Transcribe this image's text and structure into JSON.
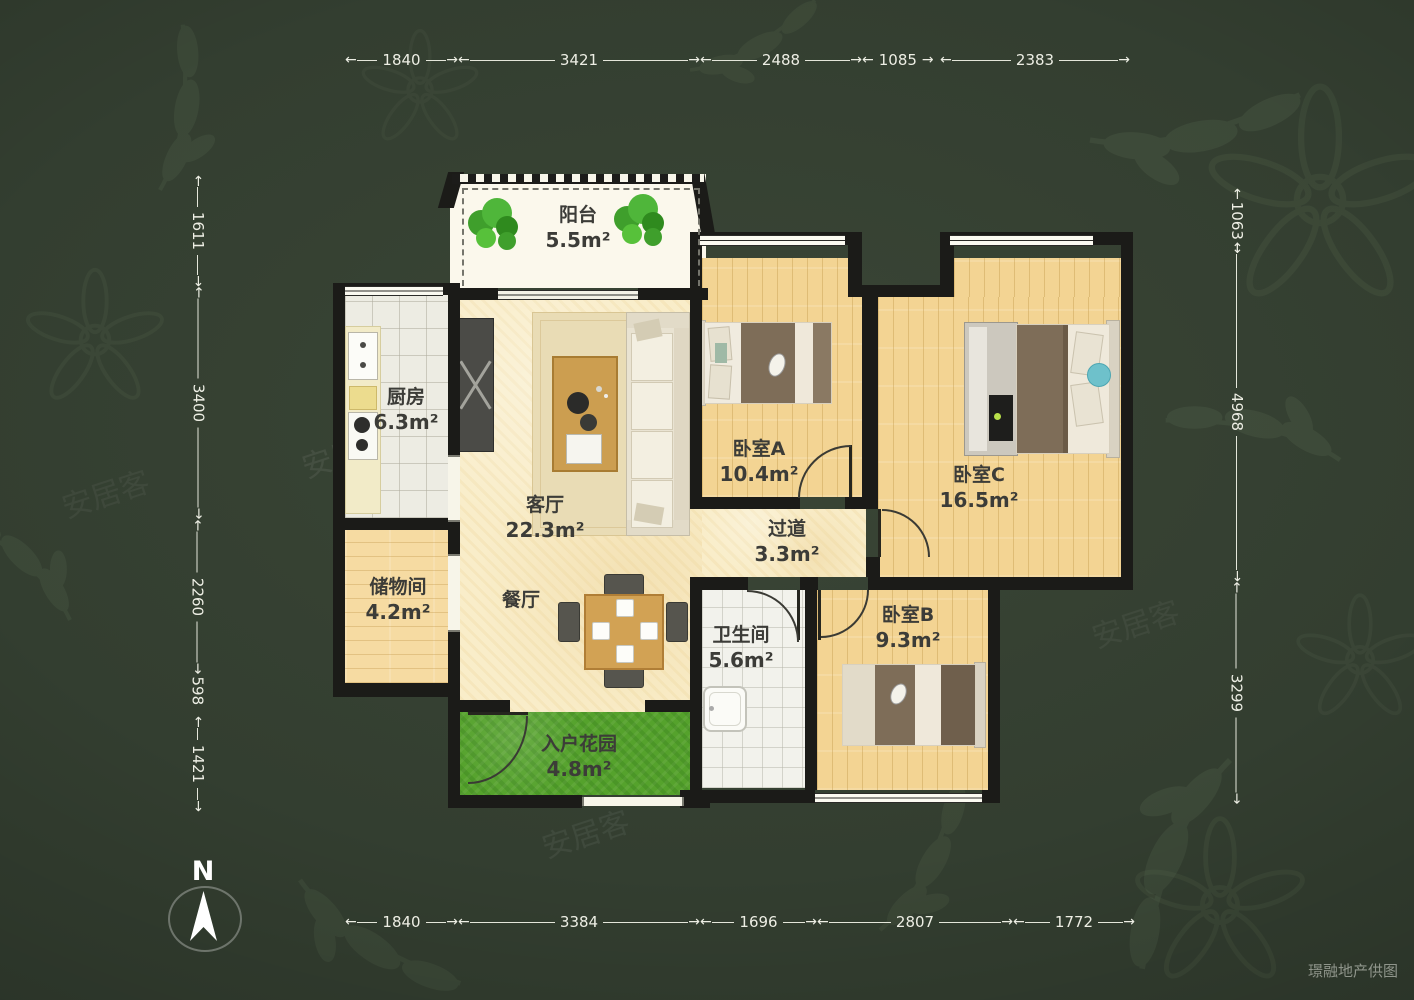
{
  "compass": {
    "label": "N"
  },
  "credit": "璟融地产供图",
  "watermark": "安居客",
  "arrows": {
    "left": "←",
    "right": "→"
  },
  "dims": {
    "top": [
      "1840",
      "3421",
      "2488",
      "1085",
      "2383"
    ],
    "bottom": [
      "1840",
      "3384",
      "1696",
      "2807",
      "1772"
    ],
    "left": [
      "1611",
      "3400",
      "2260",
      "598",
      "1421"
    ],
    "right": [
      "1063",
      "4968",
      "3299"
    ]
  },
  "rooms": {
    "balcony": {
      "name": "阳台",
      "area": "5.5m²"
    },
    "kitchen": {
      "name": "厨房",
      "area": "6.3m²"
    },
    "living": {
      "name": "客厅",
      "area": "22.3m²"
    },
    "dining": {
      "name": "餐厅"
    },
    "bedroomA": {
      "name": "卧室A",
      "area": "10.4m²"
    },
    "bedroomB": {
      "name": "卧室B",
      "area": "9.3m²"
    },
    "bedroomC": {
      "name": "卧室C",
      "area": "16.5m²"
    },
    "corridor": {
      "name": "过道",
      "area": "3.3m²"
    },
    "storage": {
      "name": "储物间",
      "area": "4.2m²"
    },
    "bathroom": {
      "name": "卫生间",
      "area": "5.6m²"
    },
    "garden": {
      "name": "入户花园",
      "area": "4.8m²"
    }
  },
  "colors": {
    "background": "#333e30",
    "wall": "#1b1b18",
    "wood_floor": "#f3d493",
    "living_floor": "#f9edc9",
    "grass": "#55a22c",
    "dim_text": "#edeee4",
    "label_text": "#3c3c38"
  }
}
